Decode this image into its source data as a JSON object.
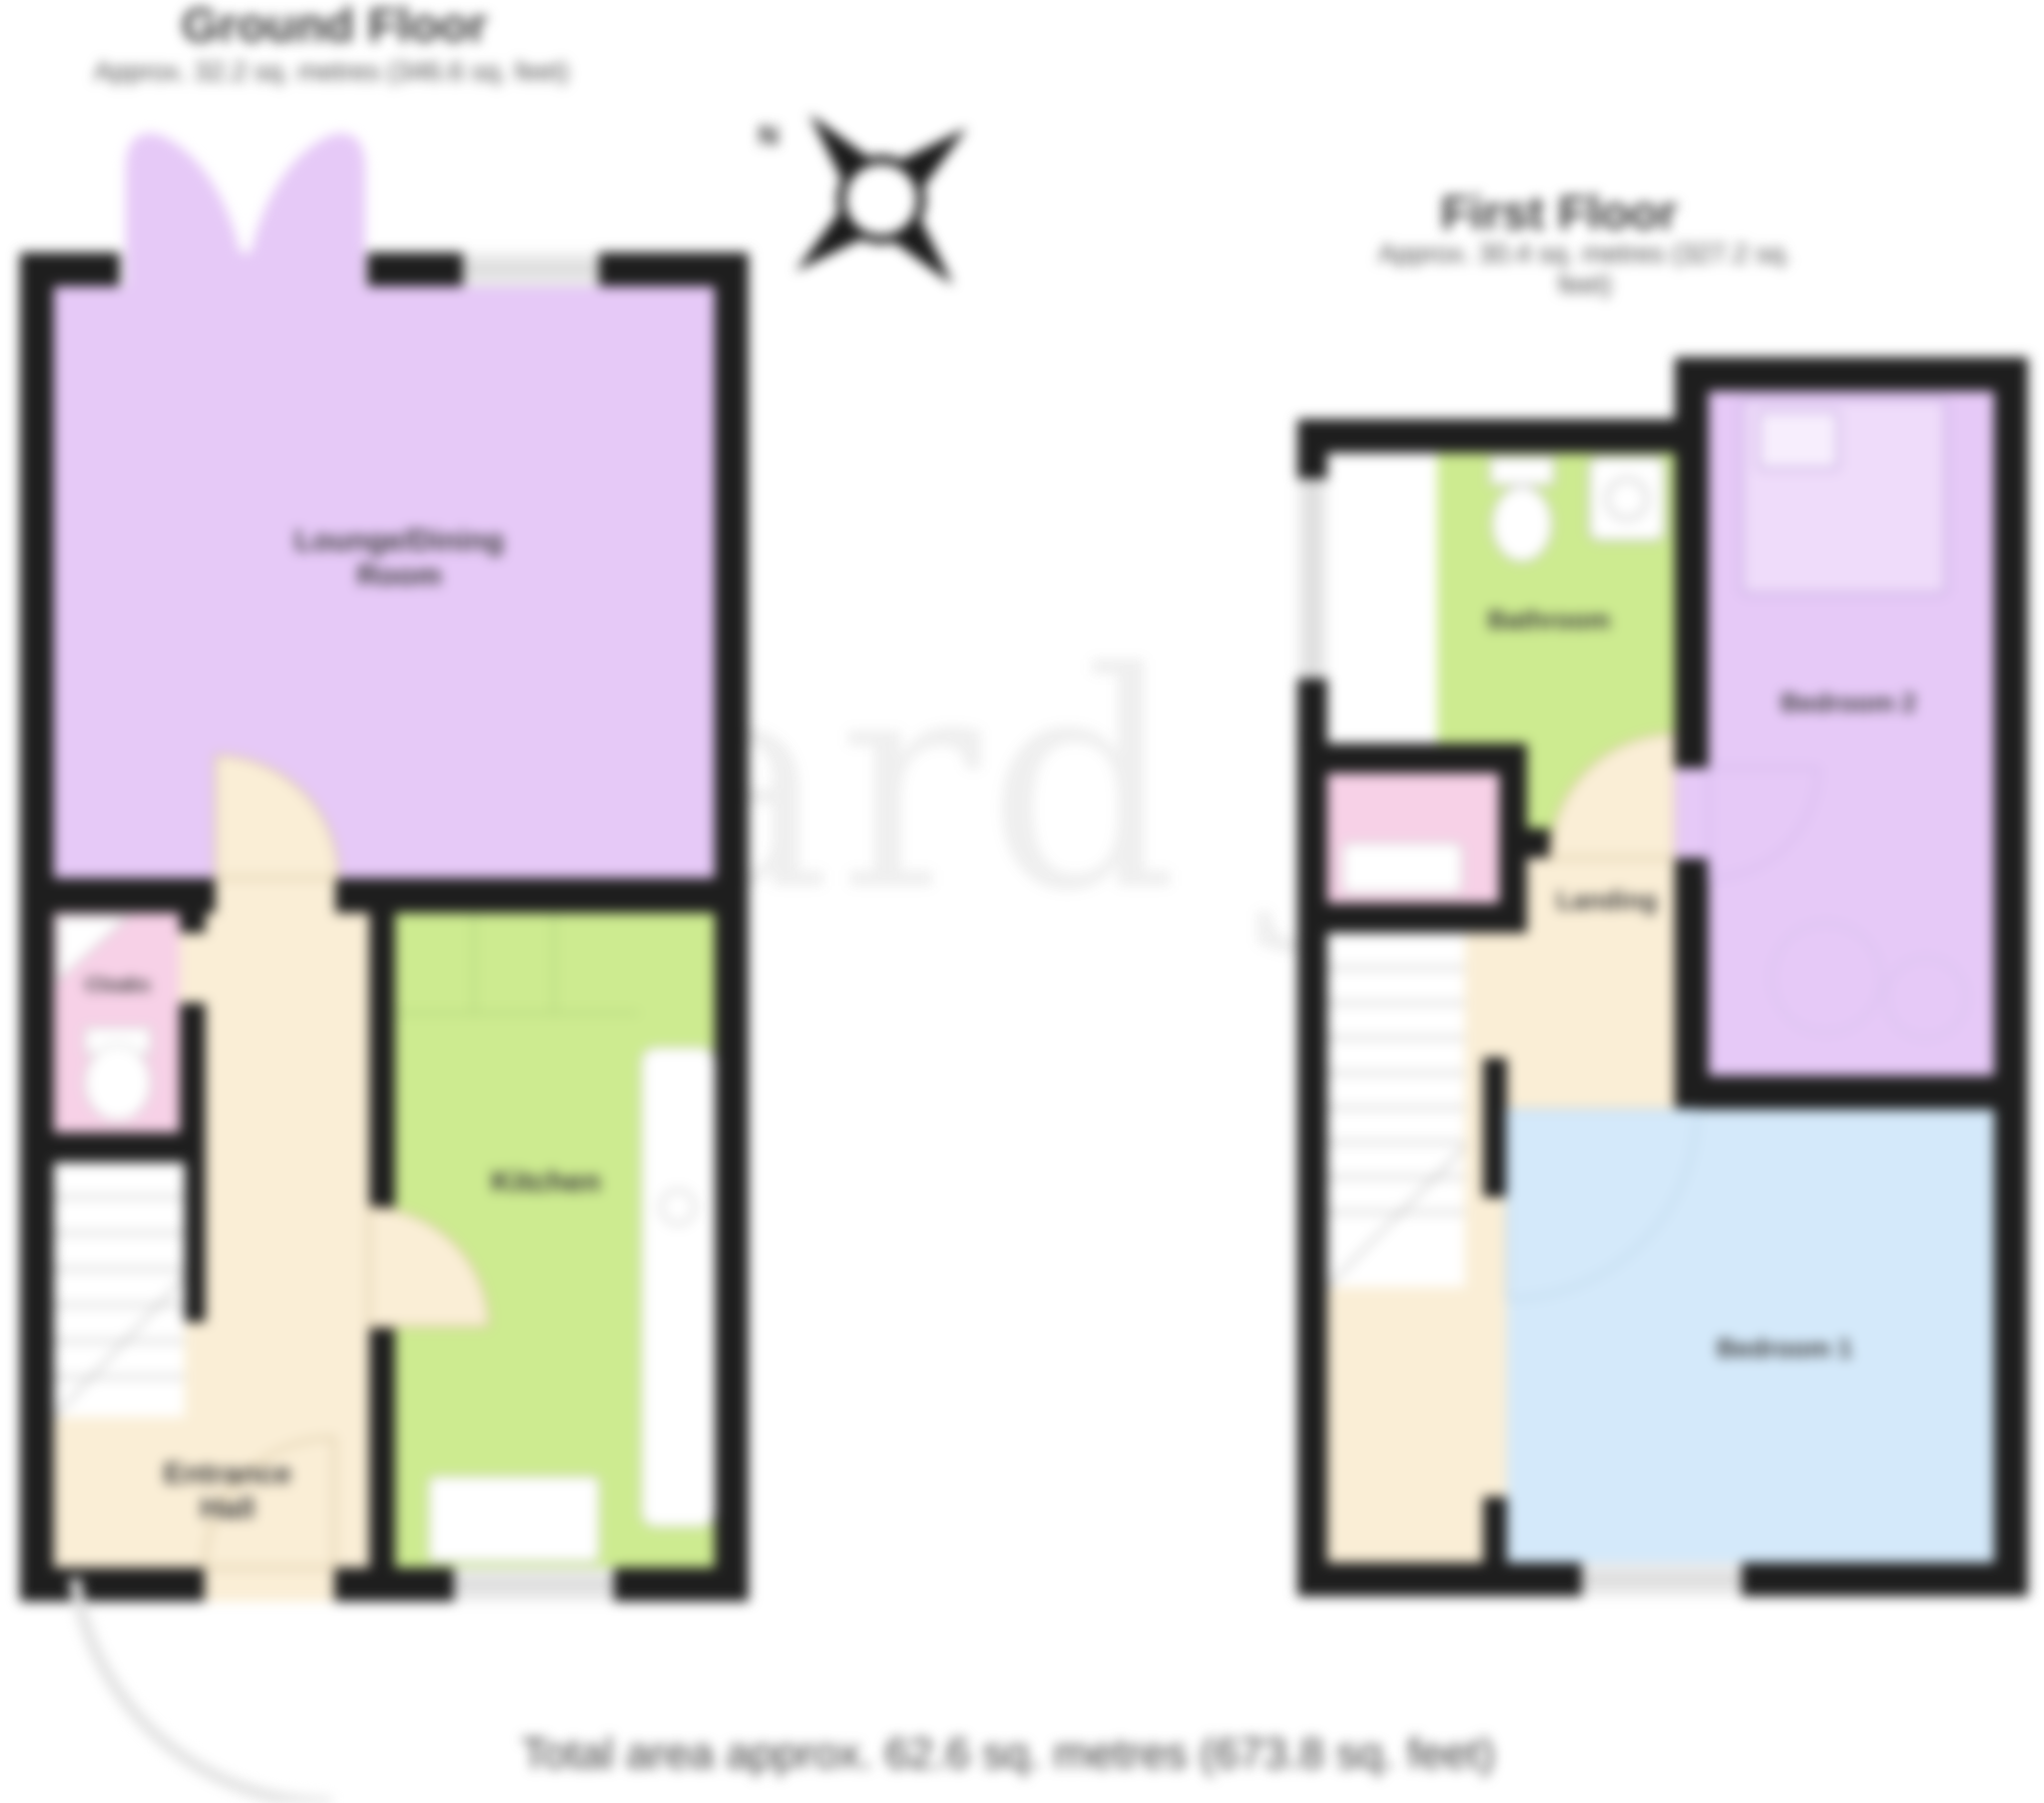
{
  "ground_floor": {
    "title": "Ground Floor",
    "subtitle": "Approx. 32.2 sq. metres (346.6 sq. feet)",
    "rooms": [
      {
        "name": "lounge-dining-room",
        "label": "Lounge/Dining\nRoom",
        "color": "#e6c9f7"
      },
      {
        "name": "kitchen",
        "label": "Kitchen",
        "color": "#cdeb90"
      },
      {
        "name": "entrance-hall",
        "label": "Entrance\nHall",
        "color": "#faeed6"
      },
      {
        "name": "cloaks",
        "label": "Cloaks",
        "color": "#f7d1e7"
      }
    ]
  },
  "first_floor": {
    "title": "First Floor",
    "subtitle": "Approx. 30.4 sq. metres (327.2 sq. feet)",
    "rooms": [
      {
        "name": "bathroom",
        "label": "Bathroom",
        "color": "#cdeb90"
      },
      {
        "name": "bedroom-2",
        "label": "Bedroom 2",
        "color": "#e6c9f7"
      },
      {
        "name": "landing",
        "label": "Landing",
        "color": "#faeed6"
      },
      {
        "name": "bedroom-1",
        "label": "Bedroom 1",
        "color": "#d4e9fa"
      }
    ]
  },
  "footer": {
    "total_area": "Total area approx. 62.6 sq. metres (673.8 sq. feet)"
  },
  "compass": {
    "north_label": "N"
  },
  "watermark": {
    "text": "richard james"
  },
  "colors": {
    "wall": "#1e1e1e",
    "lounge_purple": "#e6c9f7",
    "kitchen_green": "#cdeb90",
    "hall_cream": "#faeed6",
    "cloak_pink": "#f7d1e7",
    "bedroom_blue": "#d4e9fa",
    "window_grey": "#e9e9e9"
  }
}
